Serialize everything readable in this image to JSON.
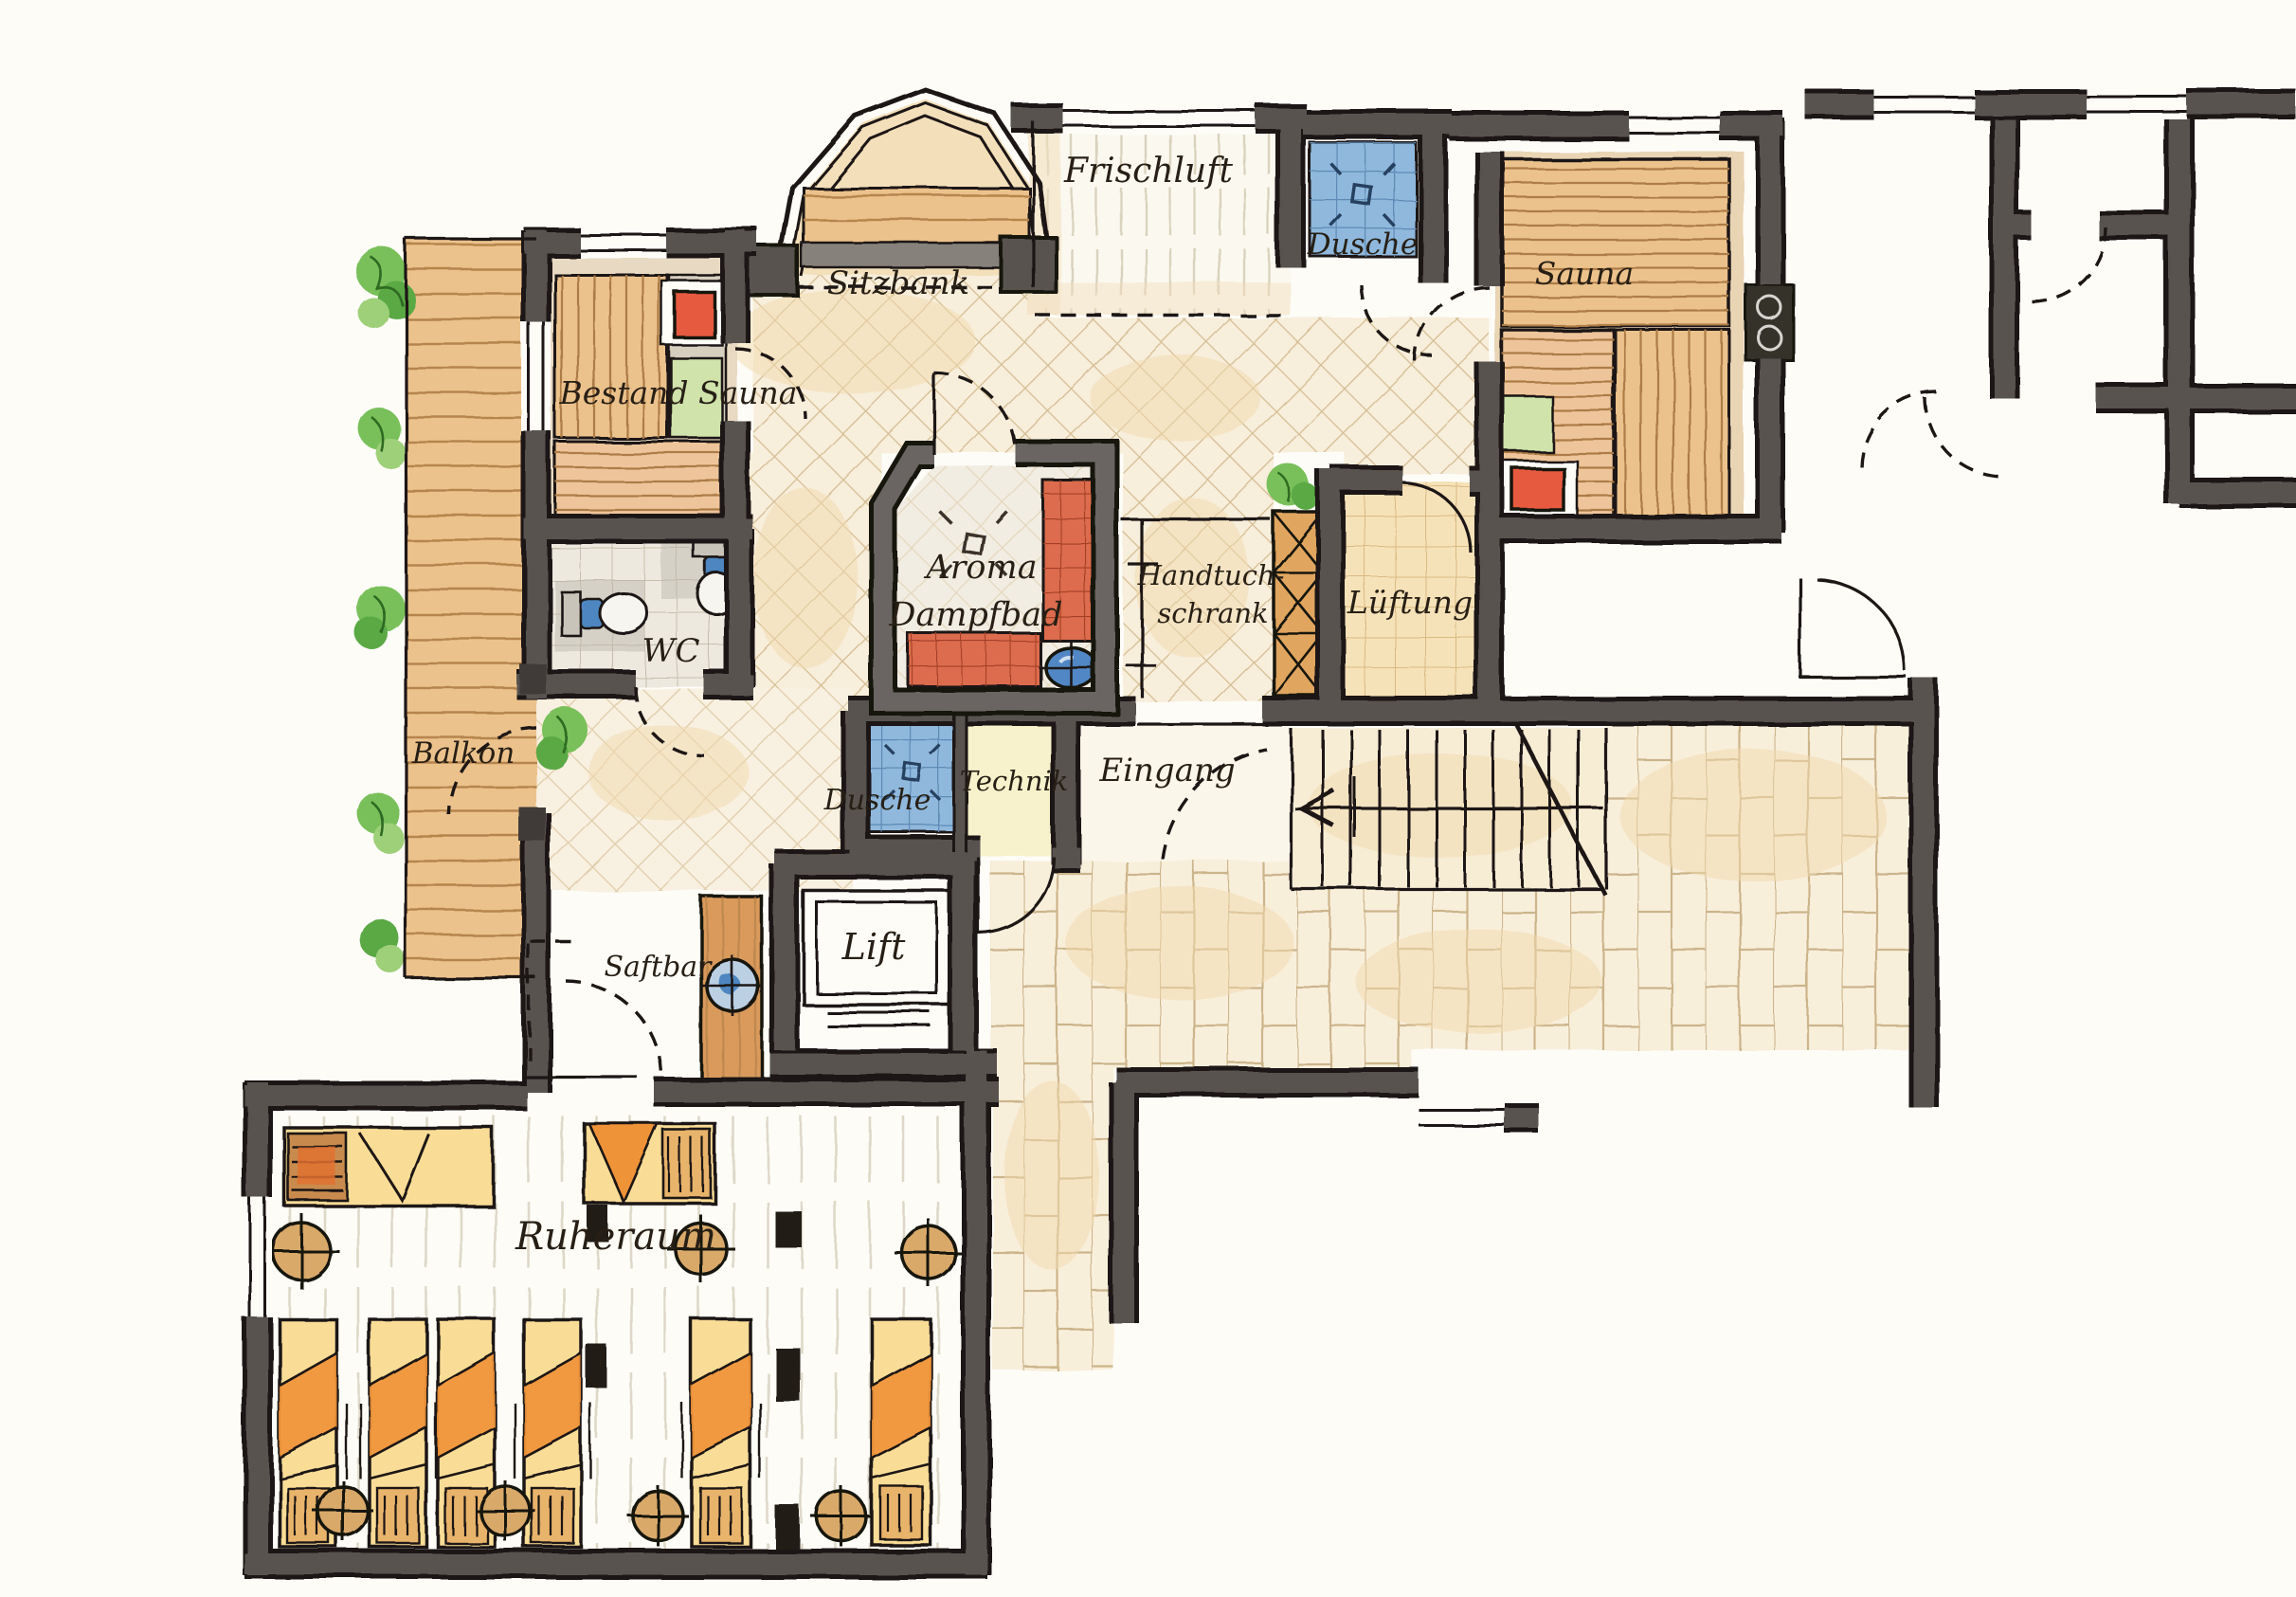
{
  "plan": {
    "labels": {
      "frischluft": "Frischluft",
      "dusche_top": "Dusche",
      "sauna": "Sauna",
      "sitzbank": "Sitzbank",
      "bestand_sauna": "Bestand Sauna",
      "wc": "WC",
      "balkon": "Balkon",
      "aroma_line1": "Aroma",
      "aroma_line2": "Dampfbad",
      "handtuch_line1": "Handtuch-",
      "handtuch_line2": "schrank",
      "lueftung": "Lüftung",
      "dusche_mitte": "Dusche",
      "technik": "Technik",
      "eingang": "Eingang",
      "lift": "Lift",
      "saftbar": "Saftbar",
      "ruheraum": "Ruheraum"
    },
    "colors": {
      "paper": "#fdfcf7",
      "ink": "#221c15",
      "wall": "#585250",
      "steam_room_wall": "#6b6562",
      "tile_cream": "#f7eedb",
      "tile_line": "#d5bd92",
      "wood": "#ecc28c",
      "wood_line": "#ad7c46",
      "counter_wood": "#d99a5c",
      "shower_blue": "#8fb8dc",
      "basin_blue": "#5187c4",
      "heater_red": "#e65a41",
      "steam_bench_red": "#dc6c4e",
      "plant_green": "#79c05a",
      "pad_green": "#cfe3ab",
      "technik_cream": "#f8f2cc",
      "lueftung_tile": "#f6e2b8",
      "lounger_yellow": "#f9dc96",
      "lounger_orange": "#ef9338",
      "table_tan": "#d9a96b",
      "wash_orange": "#f1d9ad"
    },
    "icons": {
      "steam_vent": "diamond-with-rays",
      "sauna_heater": "red-stove-in-niche",
      "sauna_oven": "wall-stove-two-coils",
      "shower_pad": "blue-tiled-square",
      "basin": "round-blue-basin",
      "toilet": "top-view-wc-pan",
      "stairs_direction": "left-arrow-on-treads",
      "plant": "climbing-greenery",
      "lounger": "towel-covered-daybed",
      "side_table": "round-table-cross",
      "towel_cabinet": "cross-braced-shelf",
      "window": "double-line-in-wall"
    }
  }
}
